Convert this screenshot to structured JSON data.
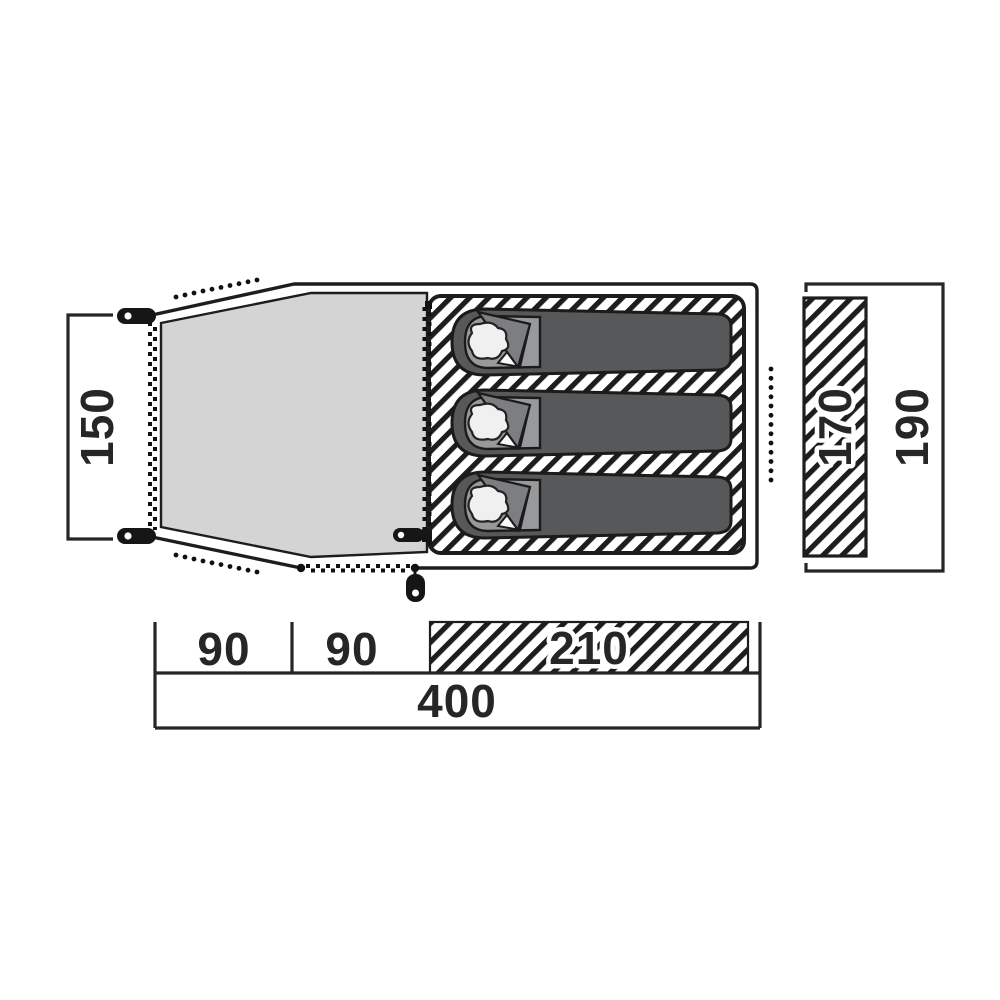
{
  "diagram": {
    "title": "Tent floor plan with dimensions (cm)",
    "dimensions": {
      "vestibule_width": "150",
      "inner_width": "170",
      "outer_width": "190",
      "segment_1": "90",
      "segment_2": "90",
      "segment_3": "210",
      "total_length": "400"
    },
    "sleeping_bag_count": 3,
    "colors": {
      "ink": "#1d1d1b",
      "vestibule_floor": "#d3d4d3",
      "bag_body": "#57585a",
      "bag_liner": "#97999b",
      "bag_flap": "#7c7e81",
      "pillow": "#f0f0f0",
      "background": "#ffffff"
    }
  }
}
